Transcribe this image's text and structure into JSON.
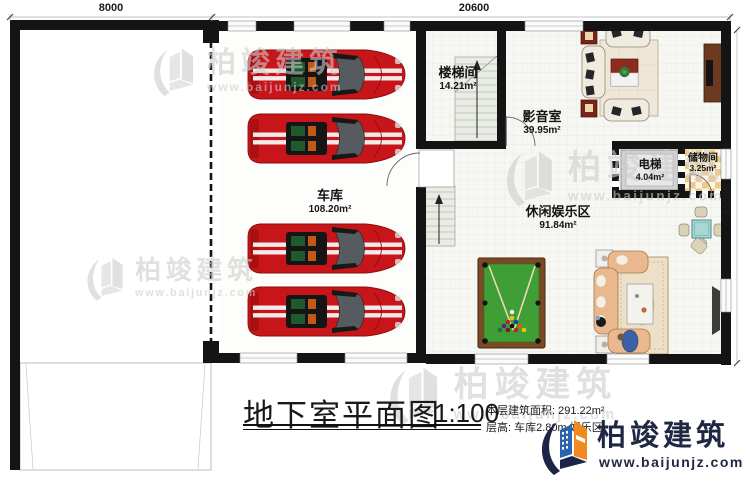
{
  "plan": {
    "dimensions": {
      "top_left": "8000",
      "top_right": "20600",
      "right_side": "15500"
    },
    "rooms": [
      {
        "id": "garage",
        "name": "车库",
        "area": "108.20m²"
      },
      {
        "id": "stairwell",
        "name": "楼梯间",
        "area": "14.21m²"
      },
      {
        "id": "media",
        "name": "影音室",
        "area": "39.95m²"
      },
      {
        "id": "elevator",
        "name": "电梯",
        "area": "4.04m²"
      },
      {
        "id": "storage",
        "name": "储物间",
        "area": "3.25m²"
      },
      {
        "id": "leisure",
        "name": "休闲娱乐区",
        "area": "91.84m²"
      }
    ]
  },
  "title_block": {
    "title": "地下室平面图",
    "scale": "1:100",
    "area_line": "本层建筑面积: 291.22m²",
    "height_line": "层高: 车库2.80m 娱乐区"
  },
  "branding": {
    "name": "柏竣建筑",
    "website": "www.baijunjz.com"
  },
  "watermark": {
    "name": "柏竣建筑",
    "website": "www.baijunjz.com"
  },
  "colors": {
    "wall": "#141414",
    "car_red": "#c8151a",
    "pool_green": "#3f9e35",
    "logo_navy": "#1f2742",
    "logo_blue": "#2a63b0",
    "logo_orange": "#f08a1e"
  }
}
